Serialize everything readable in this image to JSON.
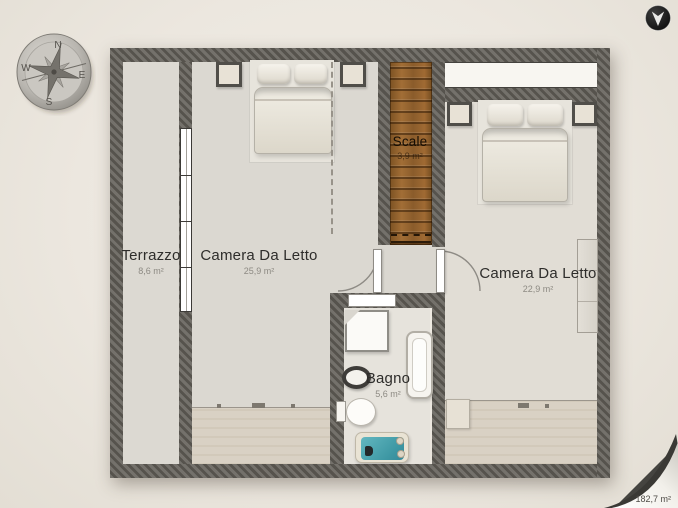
{
  "viewer": {
    "total_area": "182,7 m²"
  },
  "compass": {
    "north": "N",
    "east": "E",
    "south": "S",
    "west": "W"
  },
  "rooms": {
    "terrazzo": {
      "name": "Terrazzo",
      "area": "8,6 m²"
    },
    "bedroom_left": {
      "name": "Camera Da Letto",
      "area": "25,9 m²"
    },
    "stairs": {
      "name": "Scale",
      "area": "3,9 m²"
    },
    "bedroom_right": {
      "name": "Camera Da Letto",
      "area": "22,9 m²"
    },
    "bathroom": {
      "name": "Bagno",
      "area": "5,6 m²"
    }
  },
  "icons": {
    "collapse": "location-arrow-down-icon",
    "compass": "compass-rose-icon",
    "page_curl": "page-curl"
  },
  "colors": {
    "background": "#ece7df",
    "wall": "#59564f",
    "floor": "#dcd9d2",
    "stairs_wood": "#96642f",
    "water": "#4aa3ad"
  }
}
